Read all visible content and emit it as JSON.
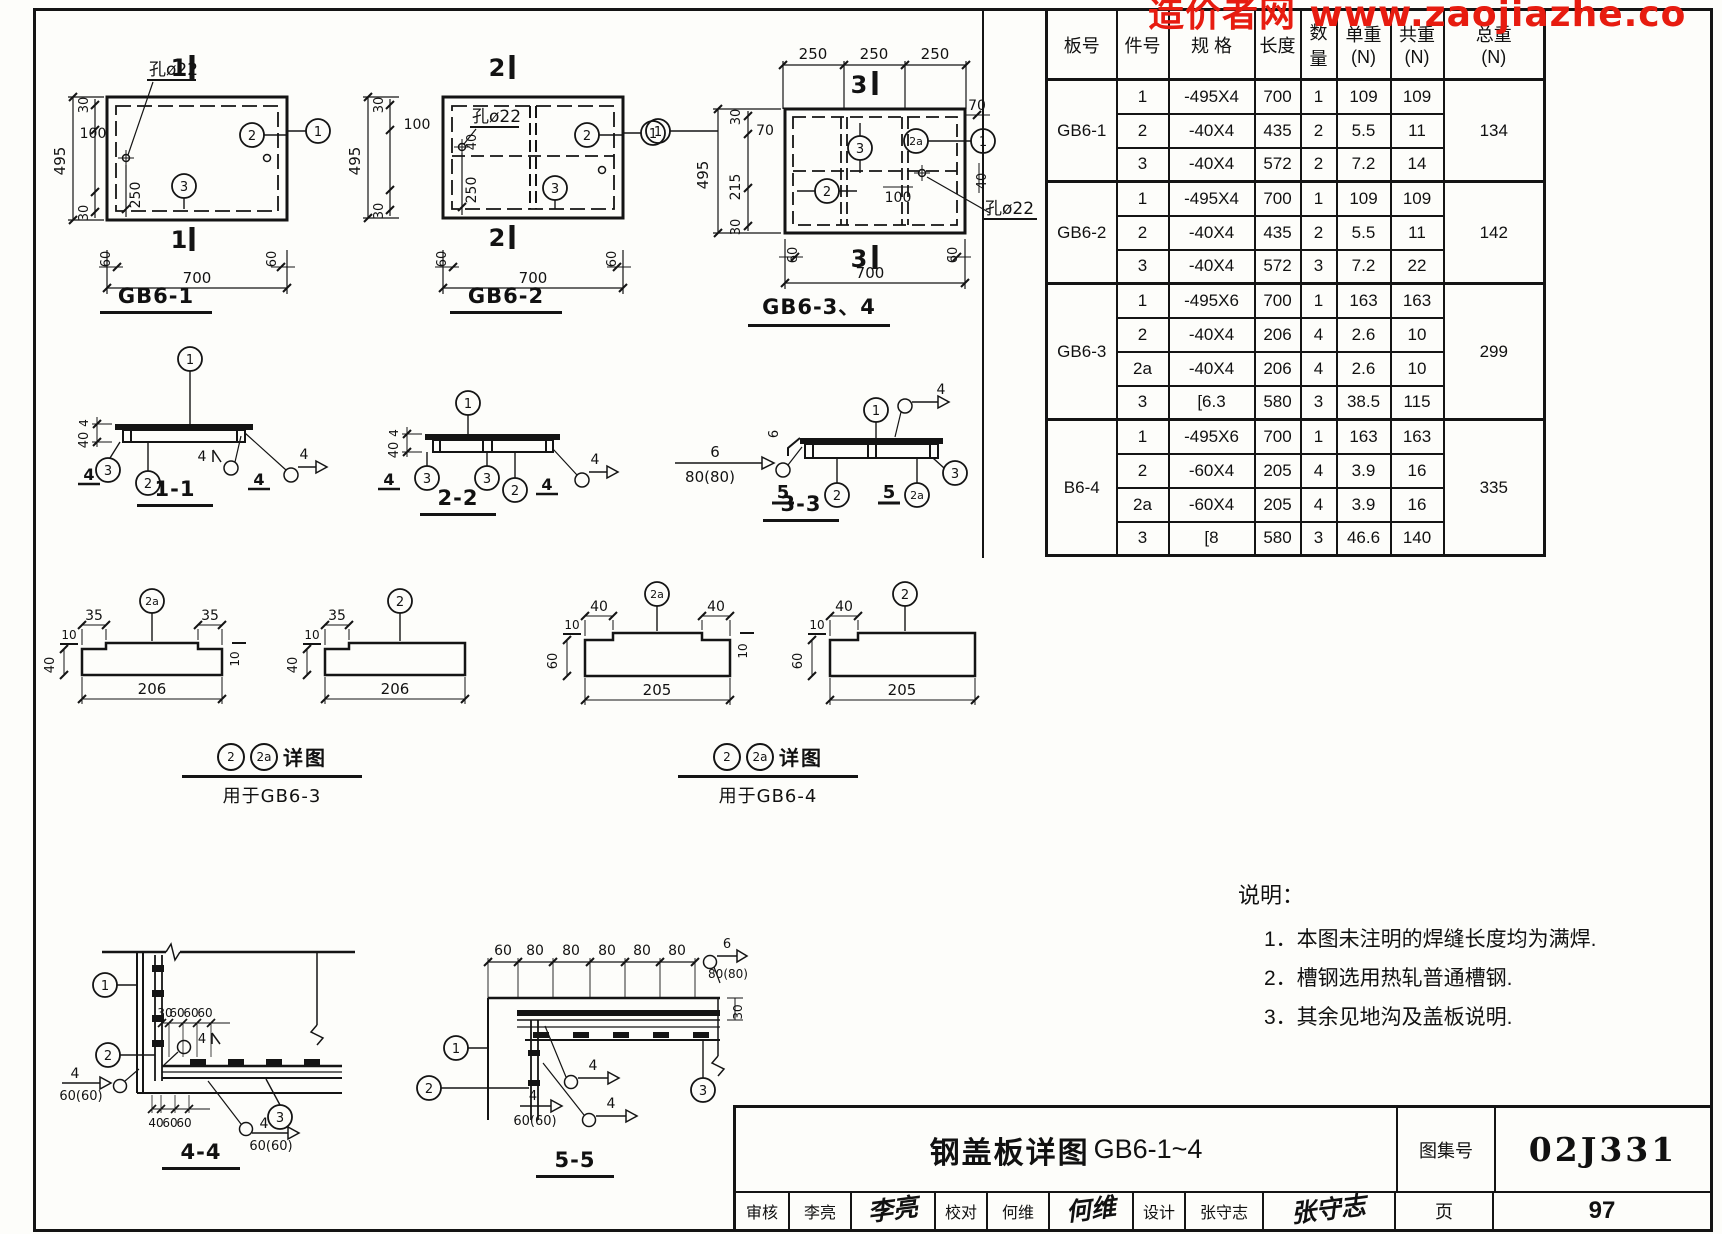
{
  "watermark": {
    "text": "造价者网 www.zaojiazhe.co"
  },
  "plans": {
    "gb61": {
      "title": "GB6-1",
      "mark": "1",
      "d30": "30",
      "d100": "100",
      "d250": "250",
      "d495": "495",
      "d60": "60",
      "d700": "700",
      "hole": "孔ø22",
      "c1": "1",
      "c2": "2",
      "c3": "3"
    },
    "gb62": {
      "title": "GB6-2",
      "mark": "2",
      "d30": "30",
      "d100": "100",
      "d40": "40",
      "d250": "250",
      "d495": "495",
      "d60": "60",
      "d700": "700",
      "hole": "孔ø22",
      "c1": "1",
      "c2": "2",
      "c3": "3"
    },
    "gb634": {
      "title": "GB6-3、4",
      "mark": "3",
      "d250": "250",
      "d70": "70",
      "d30": "30",
      "d495": "495",
      "d215": "215",
      "d60": "60",
      "d700": "700",
      "d100": "100",
      "d40": "40",
      "hole": "孔ø22",
      "c1": "1",
      "c2": "2",
      "c2a": "2a",
      "c3": "3"
    }
  },
  "sections": {
    "s11": {
      "title": "1-1",
      "c1": "1",
      "c2": "2",
      "c3": "3",
      "d40": "40",
      "d4": "4"
    },
    "s22": {
      "title": "2-2",
      "c1": "1",
      "c2": "2",
      "c3": "3",
      "d40": "40",
      "d4": "4"
    },
    "s33": {
      "title": "3-3",
      "c1": "1",
      "c2": "2",
      "c2a": "2a",
      "c3": "3",
      "d4": "4",
      "d5": "5",
      "d6": "6",
      "w80": "80(80)"
    }
  },
  "details": {
    "g3a": {
      "c": "2a",
      "dend": "35",
      "dlen": "206",
      "dh": "40",
      "dn": "10"
    },
    "g3b": {
      "c": "2",
      "dend": "35",
      "dlen": "206",
      "dh": "40",
      "dn": "10"
    },
    "g4a": {
      "c": "2a",
      "dend": "40",
      "dlen": "205",
      "dh": "60",
      "dn": "10"
    },
    "g4b": {
      "c": "2",
      "dend": "40",
      "dlen": "205",
      "dh": "60",
      "dn": "10"
    },
    "t3": {
      "c2": "2",
      "c2a": "2a",
      "label": "详图",
      "sub": "用于GB6-3"
    },
    "t4": {
      "c2": "2",
      "c2a": "2a",
      "label": "详图",
      "sub": "用于GB6-4"
    }
  },
  "c44": {
    "title": "4-4",
    "c1": "1",
    "c2": "2",
    "c3": "3",
    "d30": "30",
    "d60": "60",
    "d40": "40",
    "d4": "4",
    "w": "60(60)"
  },
  "c55": {
    "title": "5-5",
    "c1": "1",
    "c2": "2",
    "c3": "3",
    "d60": "60",
    "d80": "80",
    "d30": "30",
    "d4": "4",
    "d6": "6",
    "w80": "80(80)",
    "w60": "60(60)"
  },
  "notes": {
    "heading": "说明：",
    "items": [
      "1．本图未注明的焊缝长度均为满焊.",
      "2．槽钢选用热轧普通槽钢.",
      "3．其余见地沟及盖板说明."
    ]
  },
  "table": {
    "h": [
      "板号",
      "件号",
      "规 格",
      "长度",
      "数量",
      "单重",
      "共重",
      "总重"
    ],
    "unit": "(N)",
    "groups": [
      {
        "plate": "GB6-1",
        "total": "134",
        "rows": [
          [
            "1",
            "-495X4",
            "700",
            "1",
            "109",
            "109"
          ],
          [
            "2",
            "-40X4",
            "435",
            "2",
            "5.5",
            "11"
          ],
          [
            "3",
            "-40X4",
            "572",
            "2",
            "7.2",
            "14"
          ]
        ]
      },
      {
        "plate": "GB6-2",
        "total": "142",
        "rows": [
          [
            "1",
            "-495X4",
            "700",
            "1",
            "109",
            "109"
          ],
          [
            "2",
            "-40X4",
            "435",
            "2",
            "5.5",
            "11"
          ],
          [
            "3",
            "-40X4",
            "572",
            "3",
            "7.2",
            "22"
          ]
        ]
      },
      {
        "plate": "GB6-3",
        "total": "299",
        "rows": [
          [
            "1",
            "-495X6",
            "700",
            "1",
            "163",
            "163"
          ],
          [
            "2",
            "-40X4",
            "206",
            "4",
            "2.6",
            "10"
          ],
          [
            "2a",
            "-40X4",
            "206",
            "4",
            "2.6",
            "10"
          ],
          [
            "3",
            "[6.3",
            "580",
            "3",
            "38.5",
            "115"
          ]
        ]
      },
      {
        "plate": "B6-4",
        "total": "335",
        "rows": [
          [
            "1",
            "-495X6",
            "700",
            "1",
            "163",
            "163"
          ],
          [
            "2",
            "-60X4",
            "205",
            "4",
            "3.9",
            "16"
          ],
          [
            "2a",
            "-60X4",
            "205",
            "4",
            "3.9",
            "16"
          ],
          [
            "3",
            "[8",
            "580",
            "3",
            "46.6",
            "140"
          ]
        ]
      }
    ]
  },
  "titleblock": {
    "title_cn": "钢盖板详图",
    "title_code": "GB6-1~4",
    "atlas_label": "图集号",
    "atlas_no": "02J331",
    "page_label": "页",
    "page_no": "97",
    "review_label": "审核",
    "review_name": "李亮",
    "review_sig": "李亮",
    "check_label": "校对",
    "check_name": "何维",
    "check_sig": "何维",
    "design_label": "设计",
    "design_name": "张守志",
    "design_sig": "张守志"
  }
}
